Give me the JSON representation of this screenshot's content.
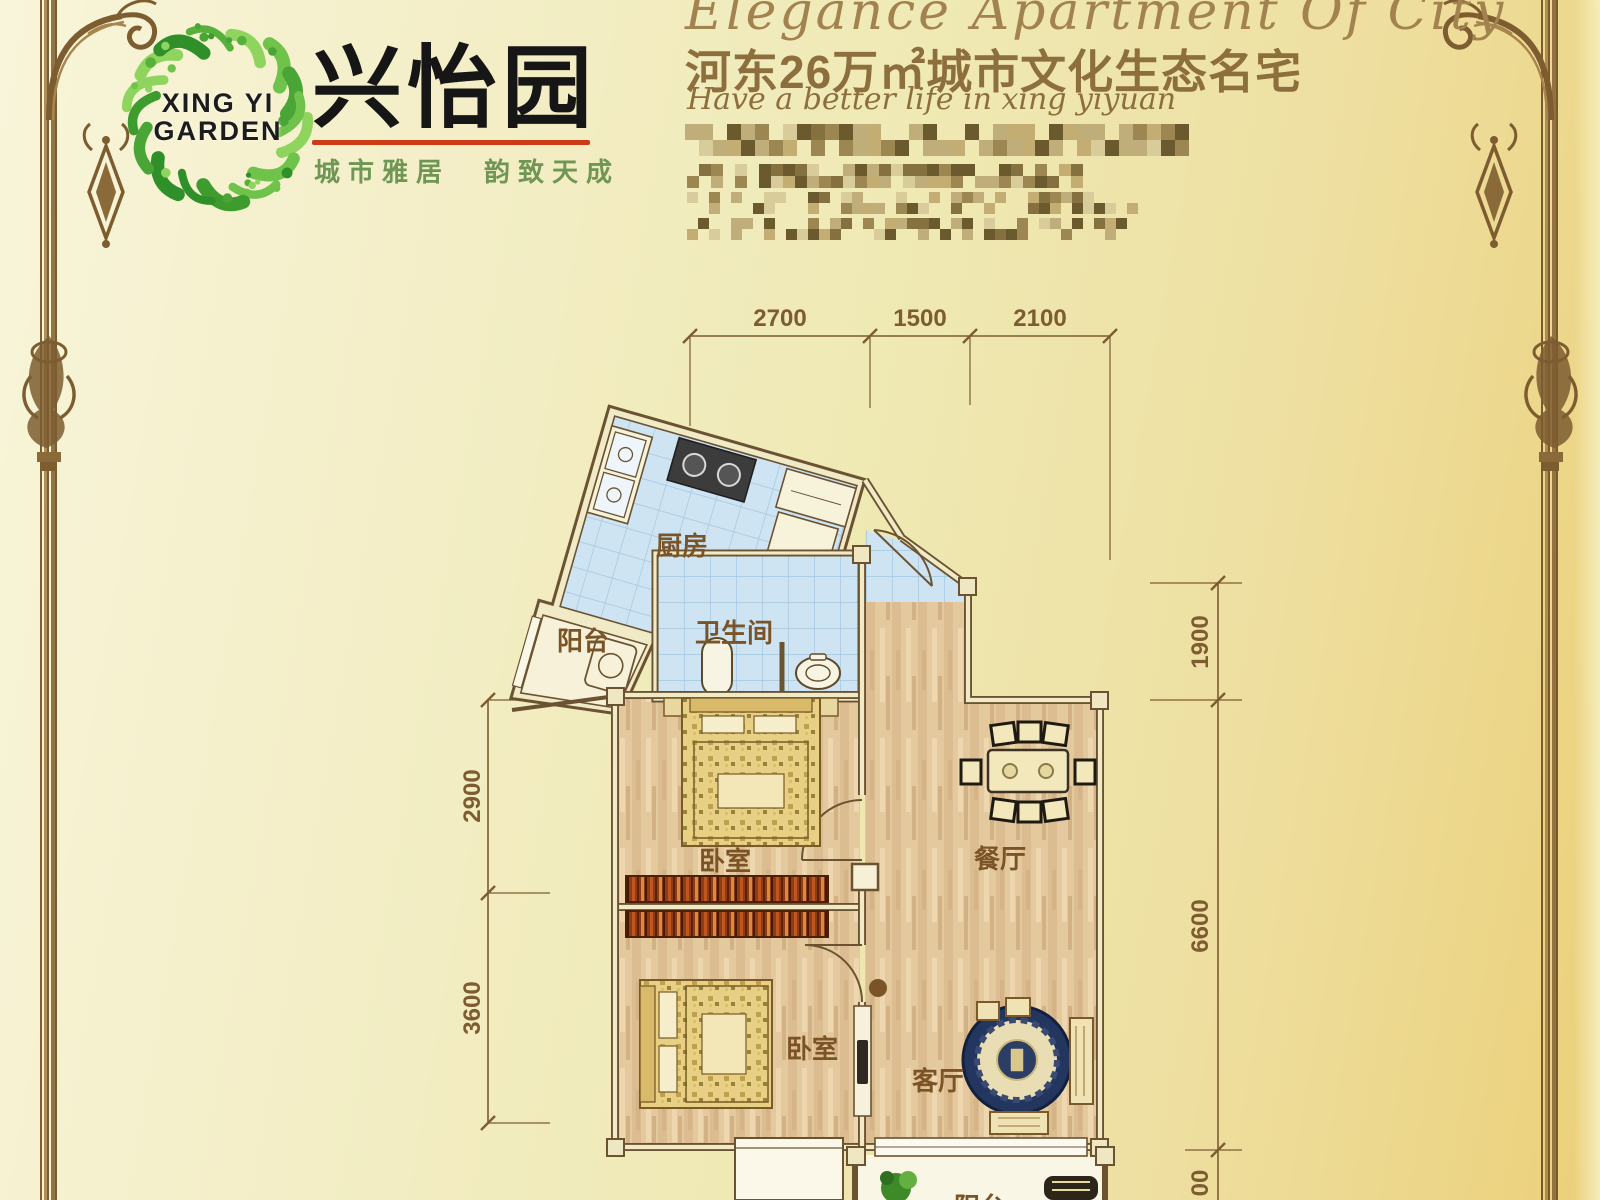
{
  "brand": {
    "logo_line1": "XING YI",
    "logo_line2": "GARDEN",
    "name_cn": "兴怡园",
    "slogan_cn": "城市雅居　韵致天成"
  },
  "header": {
    "title_en": "Elegance Apartment Of City",
    "subtitle_cn": "河东26万㎡城市文化生态名宅",
    "tagline_en": "Have a better life in xing yiyuan"
  },
  "plan": {
    "rooms": {
      "kitchen": "厨房",
      "balcony": "阳台",
      "bathroom": "卫生间",
      "bedroom1": "卧室",
      "dining": "餐厅",
      "bedroom2": "卧室",
      "living": "客厅",
      "balcony2": "阳台"
    },
    "dims": {
      "top1": "2700",
      "top2": "1500",
      "top3": "2100",
      "left1": "2900",
      "left2": "3600",
      "right1": "1900",
      "right2": "6600",
      "right3_partial": "00"
    }
  },
  "colors": {
    "accent_red": "#cc3a16",
    "logo_green": "#4aa332",
    "dim_brown": "#7c5c30",
    "wall_brown": "#6b5332",
    "tile_blue": "#cfe4f3",
    "wood_tan": "#e4c89e"
  }
}
